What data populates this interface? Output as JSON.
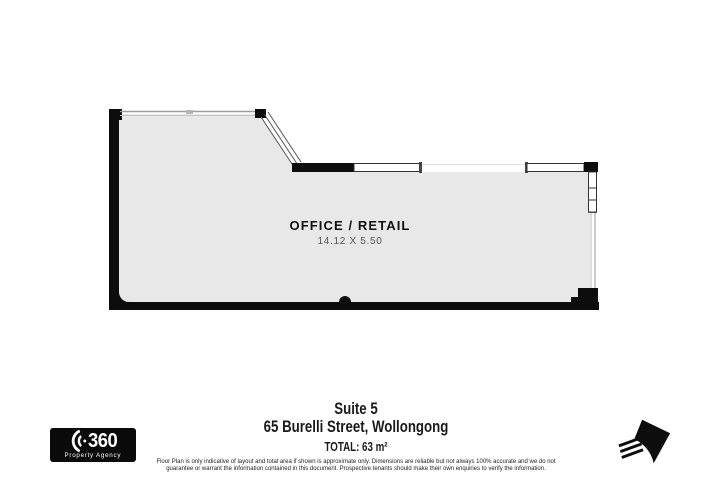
{
  "page": {
    "background": "#ffffff"
  },
  "floor_plan": {
    "room_label": "OFFICE / RETAIL",
    "room_dimensions": "14.12 X 5.50",
    "wall_color": "#0d0d0d",
    "floor_color": "#e8e8e8",
    "window_line_color": "#9a9a9a"
  },
  "footer": {
    "suite": "Suite 5",
    "address": "65 Burelli Street, Wollongong",
    "total": "TOTAL: 63 m²",
    "disclaimer_line1": "Floor Plan is only indicative of layout and total area if shown is approximate only. Dimensions are reliable but not always 100% accurate and we do not",
    "disclaimer_line2": "guarantee or warrant the information contained in this document. Prospective tenants should make their own enquiries to verify the information."
  },
  "logo": {
    "number": "360",
    "subtitle": "Property Agency"
  },
  "icons": {
    "logo_arcs": "arcs-icon",
    "north_arrow": "north-arrow-icon"
  }
}
